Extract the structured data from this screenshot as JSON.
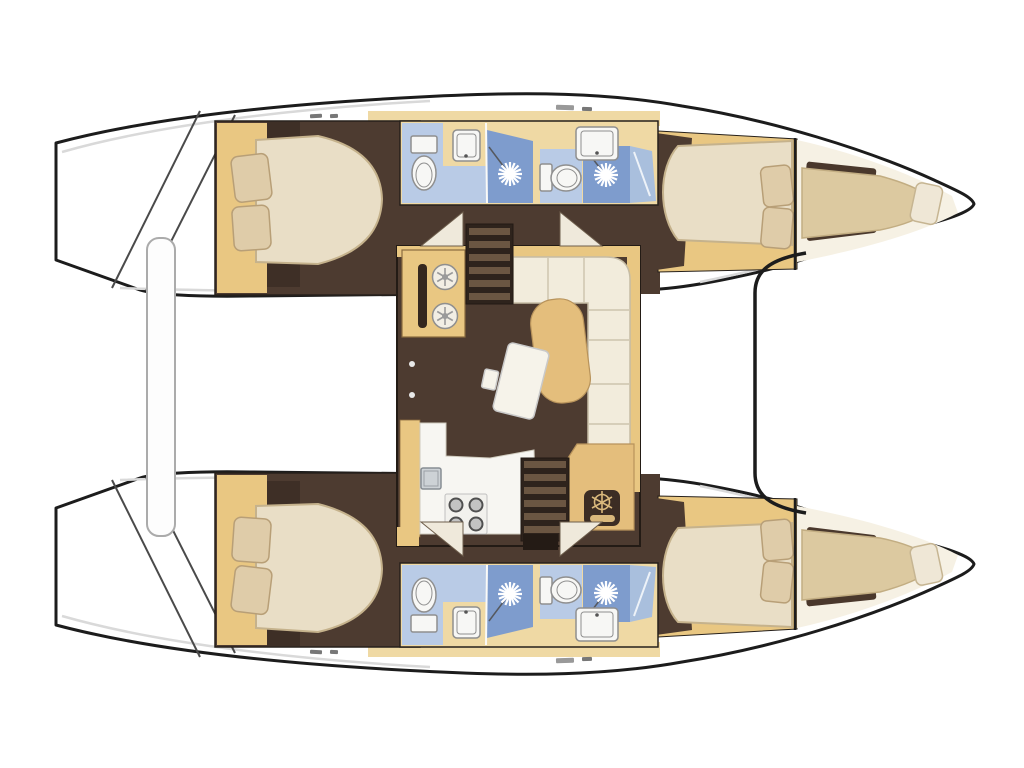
{
  "canvas": {
    "width": 1024,
    "height": 768,
    "background": "#FFFFFF"
  },
  "image": {
    "kind": "boat interior layout floor plan",
    "vessel": "catamaran, top-down view, bows pointing right",
    "cabins": 4,
    "heads": 4,
    "salon": 1
  },
  "colors": {
    "canvas_bg": "#FFFFFF",
    "outline": "#1C1C1C",
    "hull": "#FFFFFF",
    "shading": "#D9D9D9",
    "wood": "#E9C782",
    "wood_light": "#EFD9A4",
    "floor": "#4D3B30",
    "dark_block": "#3E2F26",
    "mattress": "#E9DEC6",
    "mattress_edge": "#C5B28C",
    "pillow": "#DFCCA9",
    "pillow_edge": "#B89F77",
    "sofa": "#F2ECDC",
    "sofa_line": "#C6BCA4",
    "chaise": "#E4BE7C",
    "chaise_edge": "#B8935B",
    "table": "#F6F3EA",
    "bath": "#B9CBE6",
    "shower": "#7E9CCD",
    "shower_door": "#A9BFDD",
    "fixture": "#F7F7F5",
    "fixture_edge": "#8F8F8F",
    "galley": "#F7F6F2",
    "stairs": "#2E231C",
    "tread": "#6B5642",
    "triangle": "#EFE9DB",
    "helm_bg": "#3C2D24",
    "helm_icon": "#D9B87C",
    "platform_edge": "#ABABAB"
  },
  "port_hull": {
    "aft_cabin": {
      "bed": "double",
      "pillows": 2,
      "wardrobe": true
    },
    "aft_head": {
      "toilet": true,
      "shower": true,
      "sink": true
    },
    "fwd_head": {
      "toilet": true,
      "shower": true,
      "sink": true
    },
    "fwd_cabin": {
      "bed": "double",
      "pillows": 2
    },
    "bow_berth": {
      "berth": true,
      "pillows": 1
    },
    "transom_steps": true
  },
  "starboard_hull": {
    "aft_cabin": {
      "bed": "double",
      "pillows": 2,
      "wardrobe": true
    },
    "aft_head": {
      "toilet": true,
      "shower": true,
      "sink": true
    },
    "fwd_head": {
      "toilet": true,
      "shower": true,
      "sink": true
    },
    "fwd_cabin": {
      "bed": "double",
      "pillows": 2
    },
    "bow_berth": {
      "berth": true,
      "pillows": 1
    },
    "transom_steps": true
  },
  "salon": {
    "galley": {
      "stove_burners": 4,
      "sink": true,
      "counter": "L-shaped"
    },
    "cooktop_unit": {
      "burners": 2
    },
    "sofa": "L-shaped",
    "chaise_cushion": true,
    "table": true,
    "chart_table": {
      "helm_wheel_icon": true
    },
    "companionway_stairs": 2,
    "hull_doors": 4
  },
  "deck": {
    "aft_platform": true,
    "foredeck": true,
    "bridgedeck_front": true
  }
}
